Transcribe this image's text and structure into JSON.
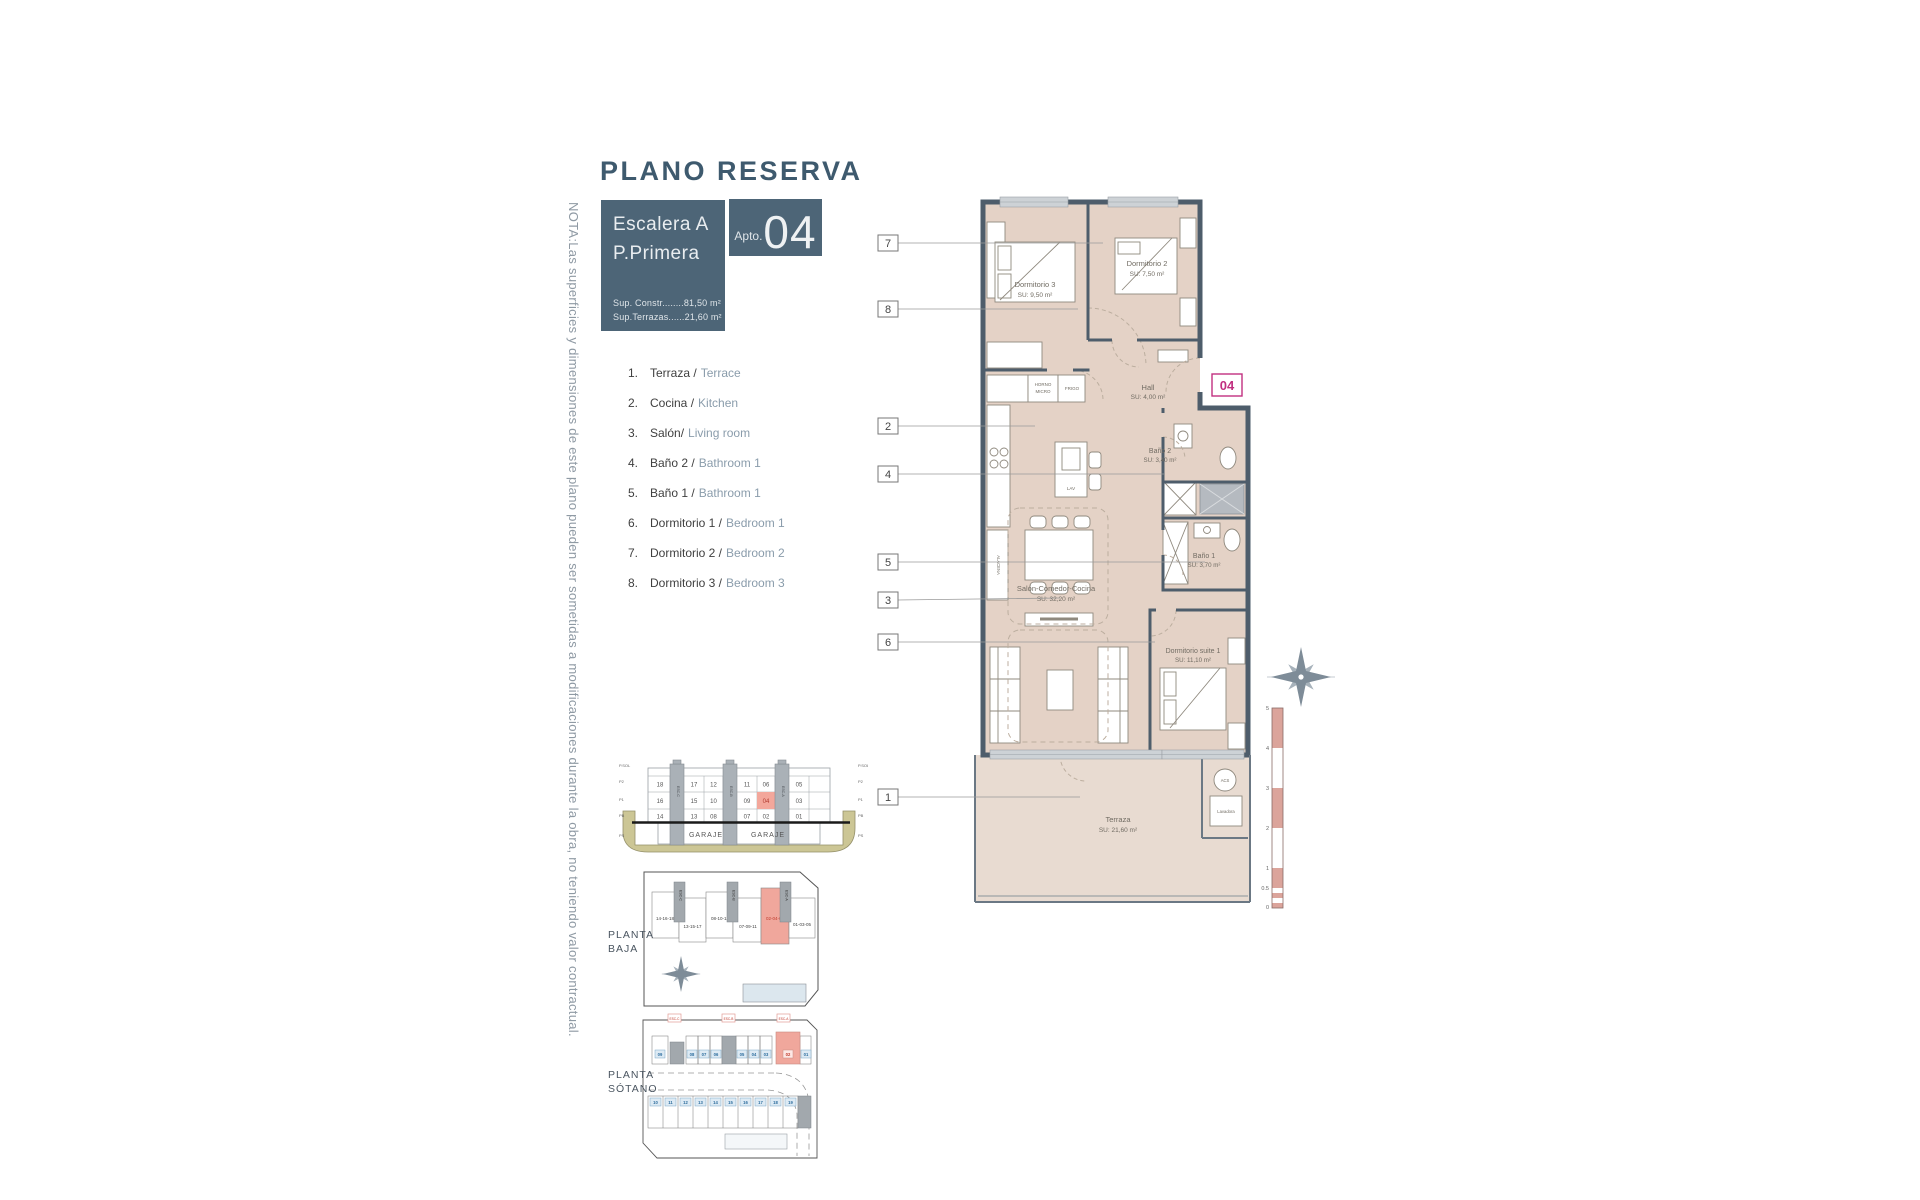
{
  "title": "PLANO RESERVA",
  "note": "NOTA:Las superficies y dimensiones de este plano pueden ser sometidas a modificaciones durante la obra, no teniendo valor contractual.",
  "header": {
    "escalera": "Escalera A",
    "planta": "P.Primera",
    "sup_constr": "Sup. Constr........81,50 m²",
    "sup_terrazas": "Sup.Terrazas......21,60 m²",
    "apto_label": "Apto.",
    "apto_number": "04"
  },
  "legend": {
    "items": [
      {
        "num": "1.",
        "es": "Terraza /",
        "en": "Terrace"
      },
      {
        "num": "2.",
        "es": "Cocina /",
        "en": "Kitchen"
      },
      {
        "num": "3.",
        "es": "Salón/",
        "en": "Living room"
      },
      {
        "num": "4.",
        "es": "Baño 2 /",
        "en": "Bathroom 1"
      },
      {
        "num": "5.",
        "es": "Baño 1 /",
        "en": "Bathroom 1"
      },
      {
        "num": "6.",
        "es": "Dormitorio 1 /",
        "en": "Bedroom 1"
      },
      {
        "num": "7.",
        "es": "Dormitorio 2 /",
        "en": "Bedroom 2"
      },
      {
        "num": "8.",
        "es": "Dormitorio 3 /",
        "en": "Bedroom 3"
      }
    ]
  },
  "plan": {
    "unit_badge": "04",
    "rooms": [
      {
        "name": "Dormitorio 3",
        "area": "SU: 9,50 m²"
      },
      {
        "name": "Dormitorio 2",
        "area": "SU: 7,50 m²"
      },
      {
        "name": "Hall",
        "area": "SU: 4,00 m²"
      },
      {
        "name": "Baño 2",
        "area": "SU: 3,40 m²"
      },
      {
        "name": "Baño 1",
        "area": "SU: 3,70 m²"
      },
      {
        "name": "Salón-Comedor-Cocina",
        "area": "SU: 32,20 m²"
      },
      {
        "name": "Dormitorio suite 1",
        "area": "SU: 11,10 m²"
      },
      {
        "name": "Terraza",
        "area": "SU: 21,60 m²"
      }
    ],
    "callouts": [
      "7",
      "8",
      "2",
      "4",
      "5",
      "3",
      "6",
      "1"
    ],
    "fixtures": {
      "horno": "HORNO",
      "micro": "MICRO",
      "frigo": "FRIGO",
      "lav": "LAV",
      "alacena": "ALACENA",
      "acs": "ACS",
      "lavadora": "Lavadora"
    },
    "scale_ticks": [
      "5",
      "4",
      "3",
      "2",
      "1",
      "0.5",
      "0"
    ]
  },
  "section": {
    "rows": [
      [
        "18",
        "17",
        "12",
        "11",
        "06",
        "05"
      ],
      [
        "16",
        "15",
        "10",
        "09",
        "04",
        "03"
      ],
      [
        "14",
        "13",
        "08",
        "07",
        "02",
        "01"
      ]
    ],
    "highlighted_unit": "04",
    "garaje": [
      "GARAJE",
      "GARAJE"
    ],
    "towers": [
      "ESC-C",
      "ESC-B",
      "ESC-A"
    ],
    "floors_left": [
      "P.SOL",
      "P2",
      "P1",
      "PB",
      "PS"
    ],
    "floors_right": [
      "P.SOL",
      "P2",
      "P1",
      "PB",
      "PS"
    ]
  },
  "planta_baja": {
    "label": [
      "PLANTA",
      "BAJA"
    ],
    "blocks": [
      "14-16-18",
      "13-15-17",
      "08-10-12",
      "07-09-11",
      "02-04-06",
      "01-03-05"
    ],
    "highlighted_block": "02-04-06",
    "towers": [
      "ESC-C",
      "ESC-B",
      "ESC-A"
    ]
  },
  "planta_sotano": {
    "label": [
      "PLANTA",
      "SÓTANO"
    ],
    "markers": [
      "ESC-C",
      "ESC-B",
      "ESC-A"
    ],
    "top_row": [
      "09",
      "08",
      "07",
      "06",
      "05",
      "04",
      "03",
      "02",
      "01"
    ],
    "highlighted_stall": "02",
    "bottom_row": [
      "10",
      "11",
      "12",
      "13",
      "14",
      "15",
      "16",
      "17",
      "18",
      "19"
    ]
  },
  "colors": {
    "slate": "#4d6577",
    "wall": "#4e5d6b",
    "floor_beige": "#e4d2c6",
    "highlight_pink": "#f3a79b",
    "magenta": "#c13080",
    "legend_en": "#8a9cab",
    "ground_khaki": "#ccc695",
    "parking_blue": "#2e6e9e",
    "pool_blue": "#dce7ee"
  }
}
